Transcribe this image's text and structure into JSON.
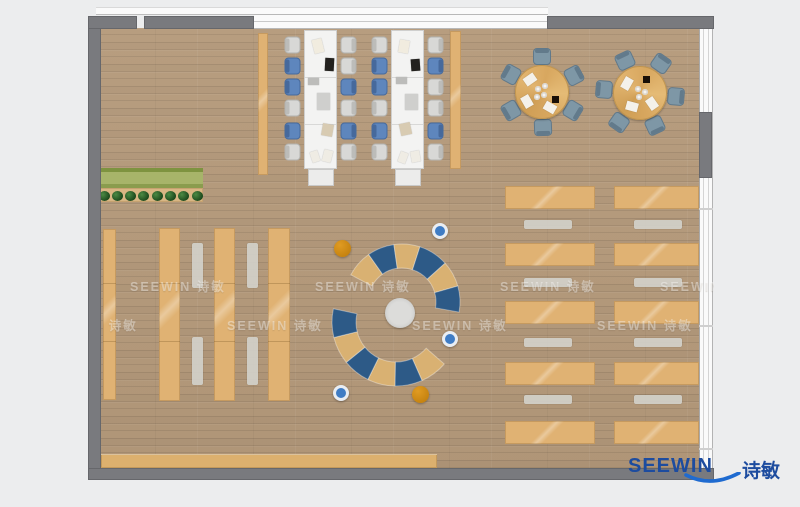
{
  "title": "SEEWIN office library floor plan rendering",
  "watermark": {
    "text": "SEEWIN 诗敏",
    "rows": [
      {
        "y": 276,
        "xs": [
          130,
          315,
          500,
          660
        ]
      },
      {
        "y": 315,
        "xs": [
          42,
          227,
          412,
          597
        ]
      }
    ]
  },
  "logo": {
    "text_en": "SEEWIN",
    "text_zh": "诗敏",
    "color": "#1d4c9f",
    "swoosh_color": "#1f6bd0"
  },
  "plan": {
    "bg": "#ecedee",
    "floor": {
      "x": 100,
      "y": 28,
      "w": 600,
      "h": 440
    },
    "windows": {
      "top_sill": {
        "x": 96,
        "y": 7,
        "w": 452,
        "h": 8
      },
      "top_band": {
        "x": 254,
        "y": 14,
        "w": 294,
        "h": 15
      },
      "right_band": {
        "x": 699,
        "y": 28,
        "w": 14,
        "h": 440
      },
      "right_dividers_y": [
        208,
        325,
        448
      ]
    },
    "walls": [
      {
        "name": "wall-left",
        "x": 88,
        "y": 16,
        "w": 13,
        "h": 463
      },
      {
        "name": "wall-top-a",
        "x": 88,
        "y": 16,
        "w": 49,
        "h": 13
      },
      {
        "name": "wall-top-b",
        "x": 144,
        "y": 16,
        "w": 110,
        "h": 13
      },
      {
        "name": "wall-top-c",
        "x": 547,
        "y": 16,
        "w": 167,
        "h": 13
      },
      {
        "name": "wall-right-mid",
        "x": 699,
        "y": 112,
        "w": 13,
        "h": 66
      },
      {
        "name": "wall-bottom",
        "x": 88,
        "y": 468,
        "w": 626,
        "h": 12
      }
    ],
    "colors": {
      "wall": "#797a7e",
      "tan": "#e0b273",
      "white_desk": "#f3f3f2",
      "gray_chair": "#d8d8d6",
      "blue_chair": "#5e86bd",
      "slate_chair": "#7e97a6",
      "bench": "#d3d1cb",
      "arc_blue": "#2d5a87",
      "arc_tan": "#d9b172",
      "pouf_blue": "#3f7cc4",
      "pouf_ring": "#e9edf2",
      "pouf_orange": "#c5820f",
      "green_dark": "#7e9340",
      "green": "#a7b46a",
      "green_edge": "#8a9c4e",
      "plant": "#1d4a1d",
      "plant_hi": "#4c8a44",
      "plant_shelf": "#d9b684",
      "counter": "#dcb06e",
      "table_round": "#d8a75f",
      "center_rug": "#dcdcda",
      "cabinet": "#ececeb",
      "dark_item": "#190f06"
    }
  },
  "furniture": {
    "benches_vertical": [
      {
        "x": 258,
        "y": 33,
        "w": 10,
        "h": 142
      },
      {
        "x": 450,
        "y": 31,
        "w": 11,
        "h": 138
      }
    ],
    "desk_clusters": [
      {
        "desk": {
          "x": 304,
          "y": 30,
          "w": 33,
          "h": 139
        },
        "cabinet": {
          "x": 308,
          "y": 169,
          "w": 26,
          "h": 17
        },
        "chair_ys": [
          37,
          58,
          79,
          100,
          123,
          144
        ],
        "left_colors": [
          "g",
          "b",
          "b",
          "g",
          "b",
          "g"
        ],
        "right_colors": [
          "g",
          "g",
          "b",
          "g",
          "b",
          "g"
        ],
        "items": [
          {
            "x": 8,
            "y": 8,
            "w": 10,
            "h": 14,
            "r": -14,
            "c": "#f1ecdf"
          },
          {
            "x": 20,
            "y": 27,
            "w": 9,
            "h": 13,
            "r": 3,
            "c": "#23211e"
          },
          {
            "x": 3,
            "y": 47,
            "w": 11,
            "h": 7,
            "r": 0,
            "c": "#bcbcba"
          },
          {
            "x": 12,
            "y": 62,
            "w": 13,
            "h": 17,
            "r": 0,
            "c": "#cfcfcd"
          },
          {
            "x": 17,
            "y": 93,
            "w": 11,
            "h": 12,
            "r": 10,
            "c": "#d8cbb2"
          },
          {
            "x": 6,
            "y": 120,
            "w": 8,
            "h": 11,
            "r": -18,
            "c": "#efece4"
          },
          {
            "x": 18,
            "y": 119,
            "w": 9,
            "h": 12,
            "r": 14,
            "c": "#efece4"
          }
        ]
      },
      {
        "desk": {
          "x": 391,
          "y": 30,
          "w": 33,
          "h": 139
        },
        "cabinet": {
          "x": 395,
          "y": 169,
          "w": 26,
          "h": 17
        },
        "chair_ys": [
          37,
          58,
          79,
          100,
          123,
          144
        ],
        "left_colors": [
          "g",
          "b",
          "b",
          "g",
          "b",
          "g"
        ],
        "right_colors": [
          "g",
          "b",
          "g",
          "g",
          "b",
          "g"
        ],
        "items": [
          {
            "x": 7,
            "y": 9,
            "w": 10,
            "h": 13,
            "r": 10,
            "c": "#f1ecdf"
          },
          {
            "x": 19,
            "y": 28,
            "w": 9,
            "h": 12,
            "r": -4,
            "c": "#23211e"
          },
          {
            "x": 4,
            "y": 46,
            "w": 11,
            "h": 7,
            "r": 0,
            "c": "#bcbcba"
          },
          {
            "x": 13,
            "y": 63,
            "w": 13,
            "h": 16,
            "r": 0,
            "c": "#cfcfcd"
          },
          {
            "x": 8,
            "y": 92,
            "w": 11,
            "h": 12,
            "r": -12,
            "c": "#d8cbb2"
          },
          {
            "x": 7,
            "y": 121,
            "w": 8,
            "h": 11,
            "r": 20,
            "c": "#efece4"
          },
          {
            "x": 19,
            "y": 120,
            "w": 9,
            "h": 11,
            "r": -10,
            "c": "#efece4"
          }
        ]
      }
    ],
    "planter": {
      "x": 97,
      "y": 168,
      "w": 106,
      "h": 20
    },
    "plant_shelf": {
      "x": 97,
      "y": 188,
      "w": 106,
      "h": 14
    },
    "plants": {
      "count": 8,
      "cx0": 104,
      "cy": 196,
      "dx": 13.3,
      "r": 5.5
    },
    "wall_shelf": {
      "x": 103,
      "y": 229,
      "w": 13,
      "h": 171
    },
    "shelf_columns": [
      {
        "x": 159,
        "y": 228,
        "w": 21,
        "h": 173
      },
      {
        "x": 214,
        "y": 228,
        "w": 21,
        "h": 173
      },
      {
        "x": 268,
        "y": 228,
        "w": 22,
        "h": 173
      }
    ],
    "shelf_dividers_y": [
      283,
      341
    ],
    "stool_strips": [
      {
        "x": 192,
        "y": 243,
        "w": 11,
        "h": 45
      },
      {
        "x": 192,
        "y": 337,
        "w": 11,
        "h": 48
      },
      {
        "x": 247,
        "y": 243,
        "w": 11,
        "h": 45
      },
      {
        "x": 247,
        "y": 337,
        "w": 11,
        "h": 48
      }
    ],
    "round_tables": [
      {
        "cx": 542,
        "cy": 92,
        "r": 27,
        "chair_r": 36,
        "angles": [
          0,
          62,
          121,
          178,
          240,
          299
        ],
        "papers": [
          {
            "dx": -12,
            "dy": -13,
            "r": -35
          },
          {
            "dx": -15,
            "dy": 9,
            "r": 60
          },
          {
            "dx": 8,
            "dy": 15,
            "r": 30
          }
        ],
        "cups": [
          {
            "dx": -4,
            "dy": -3
          },
          {
            "dx": 3,
            "dy": -6
          },
          {
            "dx": 2,
            "dy": 3
          },
          {
            "dx": -5,
            "dy": 5
          }
        ],
        "dark": {
          "dx": 13,
          "dy": 7
        }
      },
      {
        "cx": 640,
        "cy": 93,
        "r": 27,
        "chair_r": 36,
        "angles": [
          -25,
          35,
          95,
          155,
          215,
          275
        ],
        "papers": [
          {
            "dx": -13,
            "dy": -10,
            "r": -60
          },
          {
            "dx": -8,
            "dy": 13,
            "r": 15
          },
          {
            "dx": 12,
            "dy": 10,
            "r": 55
          }
        ],
        "cups": [
          {
            "dx": -2,
            "dy": -4
          },
          {
            "dx": 5,
            "dy": -1
          },
          {
            "dx": -1,
            "dy": 4
          }
        ],
        "dark": {
          "dx": 6,
          "dy": -14
        }
      }
    ],
    "arc_lounge": {
      "center_circle": {
        "cx": 400,
        "cy": 313,
        "r": 15
      },
      "arcs": [
        {
          "cx": 402,
          "cy": 302,
          "r0": 34,
          "r1": 58,
          "start": -62,
          "segs": [
            {
              "c": "tan",
              "a": 27
            },
            {
              "c": "blue",
              "a": 27
            },
            {
              "c": "tan",
              "a": 26
            },
            {
              "c": "blue",
              "a": 30
            },
            {
              "c": "tan",
              "a": 26
            },
            {
              "c": "blue",
              "a": 26
            }
          ]
        },
        {
          "cx": 396,
          "cy": 322,
          "r0": 40,
          "r1": 64,
          "start": 131,
          "segs": [
            {
              "c": "tan",
              "a": 25
            },
            {
              "c": "blue",
              "a": 25
            },
            {
              "c": "tan",
              "a": 25
            },
            {
              "c": "blue",
              "a": 25
            },
            {
              "c": "tan",
              "a": 25
            },
            {
              "c": "blue",
              "a": 26
            }
          ]
        }
      ],
      "poufs": [
        {
          "cx": 443,
          "cy": 234,
          "r": 9,
          "kind": "blue"
        },
        {
          "cx": 343,
          "cy": 249,
          "r": 9,
          "kind": "orange"
        },
        {
          "cx": 453,
          "cy": 342,
          "r": 9,
          "kind": "blue"
        },
        {
          "cx": 344,
          "cy": 396,
          "r": 9,
          "kind": "blue"
        },
        {
          "cx": 421,
          "cy": 395,
          "r": 9,
          "kind": "orange"
        }
      ]
    },
    "right_desks": {
      "columns": [
        {
          "x": 505,
          "w": 90,
          "bench_x": 524
        },
        {
          "x": 614,
          "w": 85,
          "bench_x": 634
        }
      ],
      "desk_ys": [
        186,
        243,
        301,
        362,
        421
      ],
      "desk_h": 23,
      "bench_ys": [
        220,
        278,
        338,
        395
      ],
      "bench_w": 48,
      "bench_h": 9
    },
    "bottom_counter": {
      "x": 101,
      "y": 454,
      "w": 336,
      "h": 14
    }
  }
}
